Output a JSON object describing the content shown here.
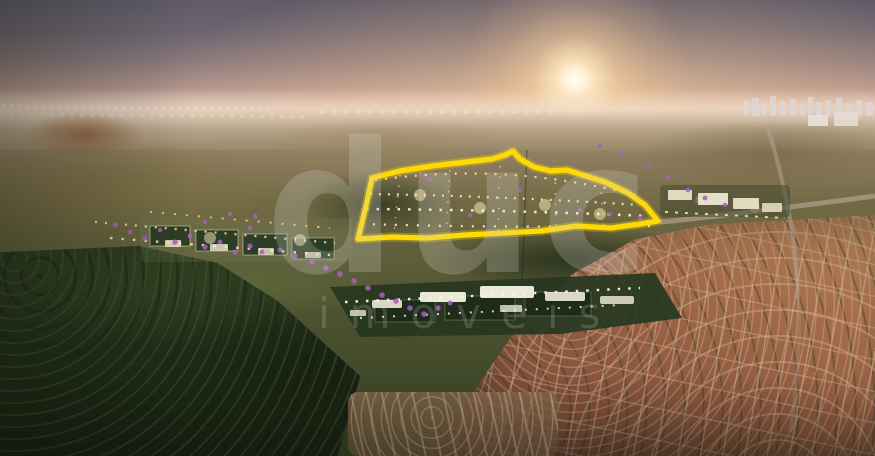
{
  "watermark": {
    "brand": "duc",
    "subtitle": "imóveis"
  },
  "highlight": {
    "outline_color": "#ffd903",
    "outline_glow_color": "rgba(255,217,0,0.30)"
  },
  "palette": {
    "sky_top": "#5e5a67",
    "sky_dusk_pink": "#b3958d",
    "horizon_glow": "#f8e9cd",
    "sun_core": "#fffdf4",
    "distant_city_haze": "#e8d8c8",
    "hills_olive": "#746b46",
    "pasture_green": "#5c683a",
    "forest_dark": "#1b2715",
    "rooftop_terracotta": "#a56f4e",
    "street_sand": "#b9ac97",
    "flowering_tree_purple": "#a95fc0",
    "community_light_warm": "#ffe3a6",
    "club_building_white": "#f4f1e2"
  }
}
